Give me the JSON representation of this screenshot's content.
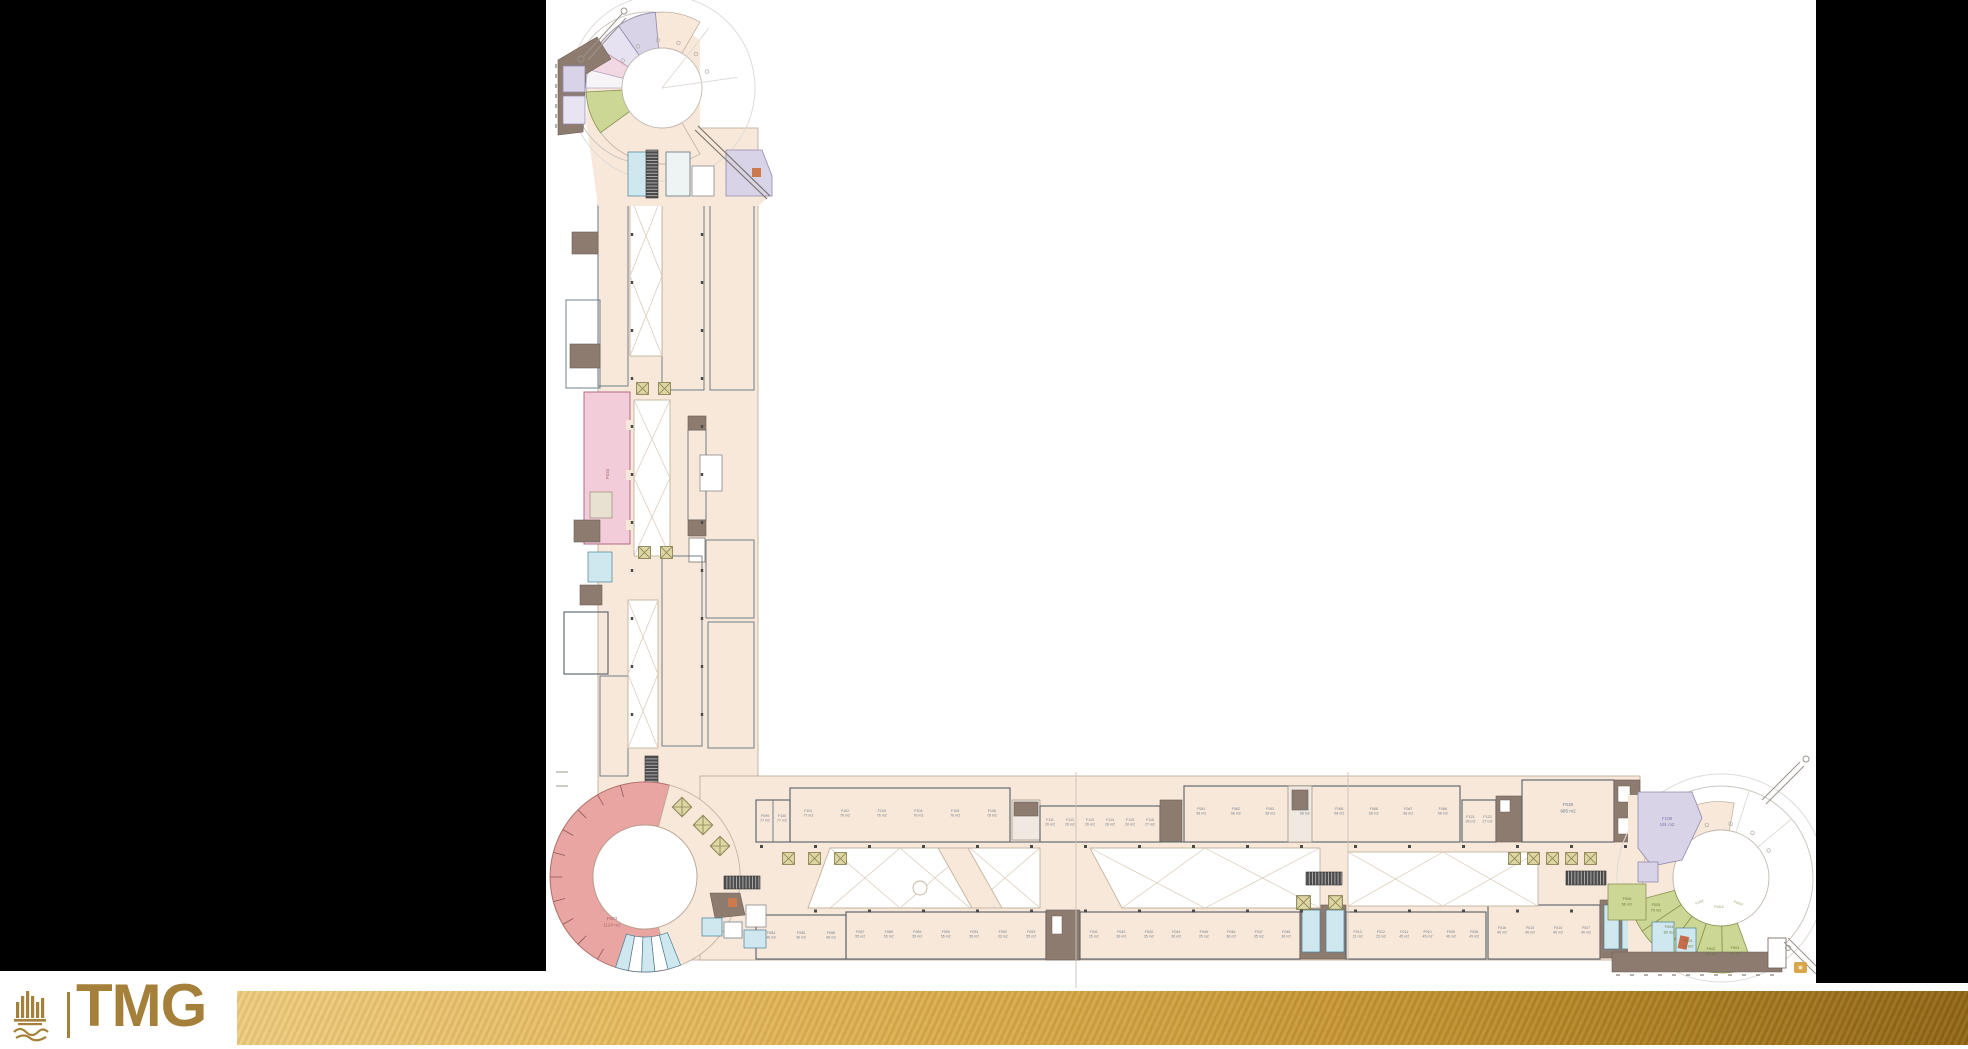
{
  "page": {
    "background": "#ffffff",
    "side_bars_color": "#000000"
  },
  "brand": {
    "logo_text": "TMG",
    "logo_color": "#a5803a",
    "emblem": "tmg-arabic-calligraphy-emblem"
  },
  "footer_bar": {
    "gradient_left": "#eecb7d",
    "gradient_mid": "#d8a747",
    "gradient_right": "#8f6414"
  },
  "floor_plan": {
    "description": "L-shaped mall floor plan with three circular court nodes",
    "colors": {
      "corridor": "#f8e8da",
      "shop": "#d2e2e4",
      "ring_salmon": "#e9a5a1",
      "anchor_pink": "#f3ccd9",
      "lavender": "#d9d3e8",
      "olive": "#ccd795",
      "restroom_cyan": "#cfe8ef",
      "service_brown": "#8d7b70",
      "kiosk": "#ded6a3"
    },
    "labels": {
      "ring_store": {
        "id": "F033",
        "area": "1124 m2"
      },
      "right_anchor": {
        "id": "F030",
        "area": "985 m2"
      },
      "lavender_shop": {
        "id": "F108",
        "area": "191 m2"
      },
      "conn_shop_a": {
        "id": "F099",
        "area": "77 m2"
      },
      "conn_shop_b": {
        "id": "F100",
        "area": "77 m2"
      },
      "pink_store": {
        "id": "F034"
      }
    },
    "green_shops": [
      {
        "id": "F006",
        "area": "56 m2"
      },
      {
        "id": "F005",
        "area": "70 m2"
      },
      {
        "id": "F004",
        "area": "80 m2"
      },
      {
        "id": "F003",
        "area": "70 m2"
      },
      {
        "id": "F002",
        "area": "60 m2"
      },
      {
        "id": "F001",
        "area": "80 m2"
      }
    ],
    "arc_shops": [
      "F1011",
      "F1012",
      "F1013"
    ],
    "rows": {
      "top_row_1": [
        {
          "id": "F101",
          "area": "77 m2"
        },
        {
          "id": "F102",
          "area": "76 m2"
        },
        {
          "id": "F103",
          "area": "76 m2"
        },
        {
          "id": "F104",
          "area": "76 m2"
        },
        {
          "id": "F105",
          "area": "76 m2"
        },
        {
          "id": "F106",
          "area": "78 m2"
        }
      ],
      "top_row_small": [
        {
          "id": "F111",
          "area": "26 m2"
        },
        {
          "id": "F112",
          "area": "26 m2"
        },
        {
          "id": "F113",
          "area": "26 m2"
        },
        {
          "id": "F114",
          "area": "28 m2"
        },
        {
          "id": "F115",
          "area": "28 m2"
        },
        {
          "id": "F116",
          "area": "27 m2"
        }
      ],
      "top_row_2": [
        {
          "id": "F061",
          "area": "58 m2"
        },
        {
          "id": "F062",
          "area": "58 m2"
        },
        {
          "id": "F063",
          "area": "58 m2"
        },
        {
          "id": "F064",
          "area": "58 m2"
        },
        {
          "id": "F065",
          "area": "58 m2"
        },
        {
          "id": "F066",
          "area": "58 m2"
        },
        {
          "id": "F067",
          "area": "58 m2"
        },
        {
          "id": "F068",
          "area": "58 m2"
        }
      ],
      "top_row_3": [
        {
          "id": "F121",
          "area": "26 m2"
        },
        {
          "id": "F122",
          "area": "27 m2"
        }
      ],
      "bottom_row_1": [
        {
          "id": "F084",
          "area": "46 m2"
        },
        {
          "id": "F085",
          "area": "46 m2"
        },
        {
          "id": "F086",
          "area": "48 m2"
        }
      ],
      "bottom_row_2": [
        {
          "id": "F087",
          "area": "55 m2"
        },
        {
          "id": "F088",
          "area": "55 m2"
        },
        {
          "id": "F089",
          "area": "55 m2"
        },
        {
          "id": "F090",
          "area": "55 m2"
        },
        {
          "id": "F091",
          "area": "55 m2"
        },
        {
          "id": "F092",
          "area": "33 m2"
        },
        {
          "id": "F093",
          "area": "55 m2"
        }
      ],
      "bottom_row_3": [
        {
          "id": "F041",
          "area": "35 m2"
        },
        {
          "id": "F042",
          "area": "36 m2"
        },
        {
          "id": "F043",
          "area": "35 m2"
        },
        {
          "id": "F044",
          "area": "36 m2"
        },
        {
          "id": "F045",
          "area": "35 m2"
        },
        {
          "id": "F046",
          "area": "36 m2"
        },
        {
          "id": "F047",
          "area": "35 m2"
        },
        {
          "id": "F048",
          "area": "36 m2"
        }
      ],
      "bottom_row_4": [
        {
          "id": "F013",
          "area": "21 m2"
        },
        {
          "id": "F012",
          "area": "23 m2"
        },
        {
          "id": "F011",
          "area": "45 m2"
        },
        {
          "id": "F010",
          "area": "45 m2"
        },
        {
          "id": "F009",
          "area": "46 m2"
        },
        {
          "id": "F008",
          "area": "45 m2"
        }
      ],
      "bottom_row_5": [
        {
          "id": "F016",
          "area": "45 m2"
        },
        {
          "id": "F015",
          "area": "45 m2"
        },
        {
          "id": "F014",
          "area": "45 m2"
        },
        {
          "id": "F007",
          "area": "45 m2"
        }
      ]
    }
  }
}
